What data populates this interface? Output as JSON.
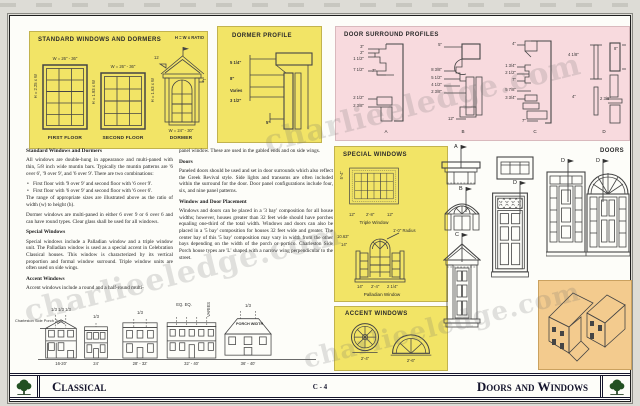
{
  "watermark": "charlieeledge.com",
  "footer": {
    "left": "Classical",
    "center": "C - 4",
    "right": "Doors and Windows"
  },
  "standard_panel": {
    "title": "STANDARD WINDOWS AND DORMERS",
    "ratio_label": "H = W x RATIO",
    "win1": {
      "top_dim": "W = 26\" - 36\"",
      "side_dim": "H = 2.25 x W",
      "caption": "FIRST FLOOR"
    },
    "win2": {
      "top_dim": "W = 26\" - 36\"",
      "side_dim": "H = 1.93 x W",
      "caption": "SECOND FLOOR"
    },
    "dormer": {
      "slope": "12",
      "eave_dim": "4\"",
      "side_dim": "H = 1.63 x W",
      "bottom_dim": "W = 24\" - 30\"",
      "caption": "DORMER"
    }
  },
  "dormer_profile": {
    "title": "DORMER PROFILE",
    "dim1": "5 1/4\"",
    "dim2": "8\"",
    "dim3": "Varies",
    "dim4": "3 1/2\"",
    "dim5": "5\""
  },
  "door_surrounds": {
    "title": "DOOR SURROUND PROFILES",
    "a": {
      "label": "A",
      "d1": "3\"",
      "d2": "2\"",
      "d3": "1 1/2\"",
      "d4": "7 1/2\"",
      "d5": "7\"",
      "d6": "2 1/2\"",
      "d7": "2 3/8\""
    },
    "b": {
      "label": "B",
      "d1": "5\"",
      "d2": "8 3/8\"",
      "d3": "5 1/2\"",
      "d4": "4 1/2\"",
      "d5": "2 3/8\"",
      "d6": "12\""
    },
    "c": {
      "label": "C",
      "d1": "4\"",
      "d2": "1 3/4\"",
      "d3": "2 1/2\"",
      "d4": "7\"",
      "d5": "5 7/8\"",
      "d6": "3 3/4\"",
      "d7": "7\""
    },
    "d": {
      "label": "D",
      "d1": "4 1/8\"",
      "d2": "8\"",
      "d3": "4\"",
      "d4": "2 3/8\""
    }
  },
  "text_col1": {
    "h1": "Standard Windows and Dormers",
    "p1": "All windows are double-hung in appearance and multi-paned with thin, 5/8 inch wide muntin bars. Typically the muntin patterns are '6 over 6', '9 over 9', and '6 over 9'. There are two combinations:",
    "b1": "First floor with '9 over 9' and second floor with '6 over 9'.",
    "b2": "First floor with '6 over 9' and second floor with '6 over 6'.",
    "p2": "The range of appropriate sizes are illustrated above as the ratio of width (w) to height (h).",
    "p3": "Dormer windows are multi-paned in either 6 over 9 or 6 over 6 and can have round types. Clear glass shall be used for all windows.",
    "h2": "Special Windows",
    "p4": "Special windows include a Palladian window and a triple window unit. The Palladian window is used as a special accent in Celebration Classical houses. This window is characterized by its vertical proportion and formal window surround. Triple window units are often used on side wings.",
    "h3": "Accent Windows",
    "p5": "Accent windows include a round and a half-round multi-"
  },
  "text_col2": {
    "p1": "panel window. These are used in the gabled ends and on side wings.",
    "h1": "Doors",
    "p2": "Paneled doors should be used and set in door surrounds which also reflect the Greek Revival style. Side lights and transoms are often included within the surround for the door. Door panel configurations include four, six, and nine panel patterns.",
    "h2": "Window and Door Placement",
    "p3": "Windows and doors can be placed in a '3 bay' composition for all house widths; however, houses greater than 32 feet wide should have porches equaling one-third of the total width. Windows and doors can also be placed in a '5 bay' composition for houses 32 feet wide and greater. The center bay of this '5 bay' composition may vary in width from the other bays depending on the width of the porch or portico. Charleston Side Porch house types are 'L' shaped with a narrow wing perpendicular to the street."
  },
  "special_panel": {
    "title": "SPECIAL WINDOWS",
    "triple": {
      "caption": "Triple Window",
      "dim_left": "12\"",
      "dim_mid": "2'-8\"",
      "dim_right": "12\"",
      "side_dim": "5'-4\""
    },
    "palladian": {
      "caption": "Palladian Window",
      "radius_label": "1'-0\" Radius",
      "dim_a": "10.63\"",
      "dim_b": "14\"",
      "bot_left": "14\"",
      "bot_mid": "2'-4\"",
      "bot_right": "2 1/4\""
    }
  },
  "accent_panel": {
    "title": "ACCENT WINDOWS",
    "round_dim": "2'-4\"",
    "half_dim": "2'-6\""
  },
  "doors_col": {
    "title": "DOORS",
    "label_a": "A",
    "label_b": "B",
    "label_c": "C",
    "label_d1": "D",
    "label_d2": "D",
    "label_d3": "D"
  },
  "elevations": {
    "callout": "Charleston Side Porch Type",
    "h1_top": "1/3  1/3  1/3",
    "h1_w": "16-20'",
    "h2_top": "1/3",
    "h2_w": "24'",
    "h3_top": "1/3",
    "h3_w": "28' - 32'",
    "h4_top": "EQ. EQ.",
    "h4_varies": "VARIES",
    "h4_w": "32' - 40'",
    "h5_top": "1/3",
    "h5_porch": "PORCH WIDTH",
    "h5_w": "36' - 40'"
  }
}
